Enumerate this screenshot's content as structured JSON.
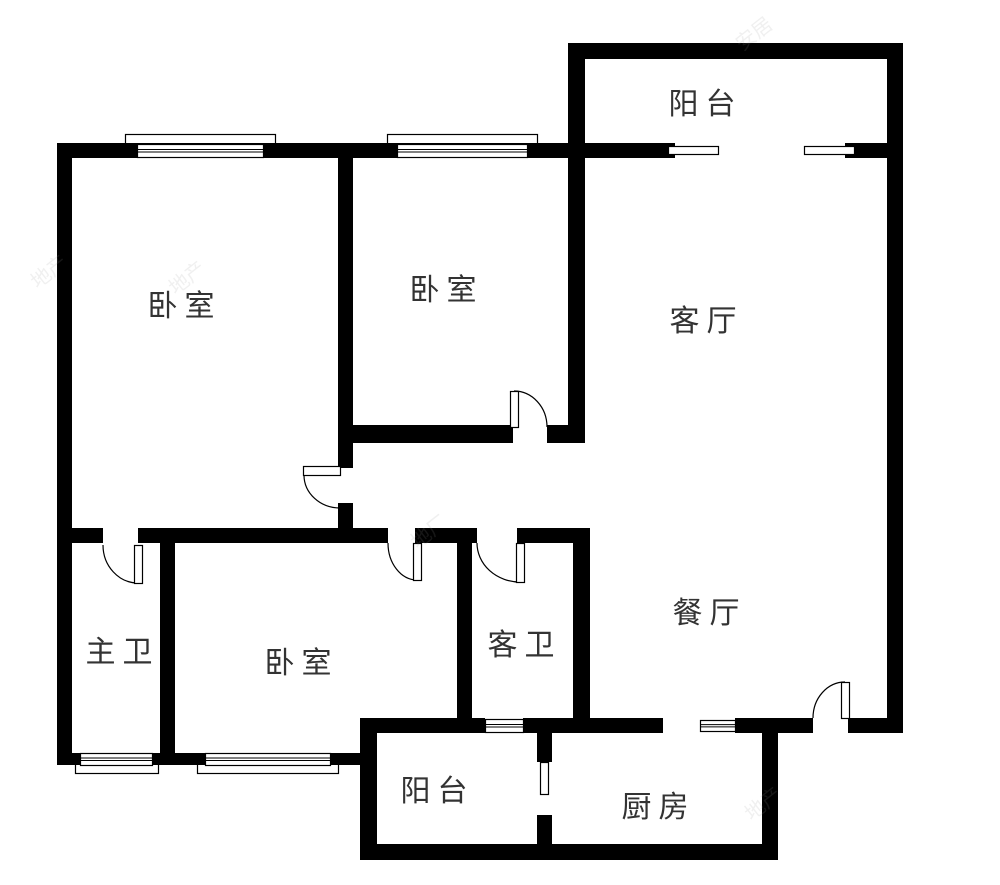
{
  "plan_title": "三室两厅户型图",
  "colors": {
    "wall": "#000000",
    "line": "#000000",
    "text": "#333333",
    "background": "#ffffff",
    "watermark": "#9a9a9a"
  },
  "rooms": [
    {
      "id": "balcony-top",
      "label": "阳台",
      "cx": 702,
      "cy": 101
    },
    {
      "id": "bedroom-1",
      "label": "卧室",
      "cx": 181,
      "cy": 303
    },
    {
      "id": "bedroom-2",
      "label": "卧室",
      "cx": 443,
      "cy": 287
    },
    {
      "id": "living-room",
      "label": "客厅",
      "cx": 703,
      "cy": 318
    },
    {
      "id": "master-bath",
      "label": "主卫",
      "cx": 119,
      "cy": 649
    },
    {
      "id": "bedroom-3",
      "label": "卧室",
      "cx": 298,
      "cy": 660
    },
    {
      "id": "guest-bath",
      "label": "客卫",
      "cx": 521,
      "cy": 642
    },
    {
      "id": "dining-room",
      "label": "餐厅",
      "cx": 706,
      "cy": 610
    },
    {
      "id": "balcony-bottom",
      "label": "阳台",
      "cx": 434,
      "cy": 788
    },
    {
      "id": "kitchen",
      "label": "厨房",
      "cx": 655,
      "cy": 804
    }
  ],
  "walls": [
    [
      57,
      143,
      528,
      15
    ],
    [
      570,
      43,
      333,
      16
    ],
    [
      57,
      143,
      15,
      622
    ],
    [
      887,
      43,
      16,
      690
    ],
    [
      568,
      43,
      17,
      400
    ],
    [
      338,
      143,
      15,
      325
    ],
    [
      338,
      503,
      15,
      40
    ],
    [
      585,
      143,
      90,
      15
    ],
    [
      845,
      143,
      58,
      15
    ],
    [
      350,
      425,
      163,
      18
    ],
    [
      547,
      425,
      38,
      18
    ],
    [
      57,
      528,
      46,
      15
    ],
    [
      138,
      528,
      250,
      15
    ],
    [
      415,
      528,
      62,
      15
    ],
    [
      517,
      528,
      73,
      15
    ],
    [
      160,
      543,
      15,
      210
    ],
    [
      457,
      543,
      15,
      175
    ],
    [
      573,
      528,
      17,
      190
    ],
    [
      360,
      718,
      125,
      15
    ],
    [
      523,
      718,
      140,
      15
    ],
    [
      735,
      718,
      78,
      15
    ],
    [
      848,
      718,
      55,
      15
    ],
    [
      360,
      718,
      17,
      140
    ],
    [
      537,
      733,
      15,
      29
    ],
    [
      537,
      815,
      15,
      30
    ],
    [
      762,
      733,
      16,
      127
    ],
    [
      57,
      753,
      23,
      12
    ],
    [
      152,
      753,
      53,
      12
    ],
    [
      330,
      753,
      30,
      12
    ],
    [
      360,
      844,
      418,
      16
    ]
  ],
  "sills": [
    [
      125,
      134,
      150,
      12
    ],
    [
      387,
      134,
      150,
      12
    ],
    [
      75,
      763,
      83,
      10
    ],
    [
      197,
      763,
      141,
      10
    ]
  ],
  "windows": [
    [
      137,
      144,
      126,
      13
    ],
    [
      397,
      144,
      130,
      13
    ],
    [
      80,
      753,
      72,
      12
    ],
    [
      205,
      753,
      125,
      12
    ],
    [
      485,
      719,
      38,
      13
    ],
    [
      700,
      720,
      35,
      11
    ]
  ],
  "sliding_panels": [
    [
      668,
      146,
      50,
      8
    ],
    [
      804,
      146,
      50,
      8
    ]
  ],
  "door_leaves": [
    [
      303,
      466,
      37,
      9
    ],
    [
      134,
      545,
      8,
      38
    ],
    [
      413,
      543,
      8,
      37
    ],
    [
      516,
      543,
      8,
      39
    ],
    [
      510,
      391,
      8,
      36
    ],
    [
      841,
      682,
      8,
      36
    ],
    [
      540,
      762,
      8,
      32
    ]
  ],
  "door_arcs": [
    "M304,475 A36,33 0 0 0 340,508",
    "M103,545 A35,38 0 0 0 138,583",
    "M388,543 A29,37 0 0 0 417,580",
    "M477,543 A43,39 0 0 0 520,582",
    "M514,391 A33,36 0 0 1 547,427",
    "M813,718 A32,36 0 0 1 845,682"
  ],
  "watermarks": [
    {
      "text": "地产",
      "x": 28,
      "y": 256
    },
    {
      "text": "地产",
      "x": 166,
      "y": 262
    },
    {
      "text": "地厂",
      "x": 408,
      "y": 516
    },
    {
      "text": "安居",
      "x": 733,
      "y": 18
    },
    {
      "text": "地产",
      "x": 742,
      "y": 788
    }
  ]
}
